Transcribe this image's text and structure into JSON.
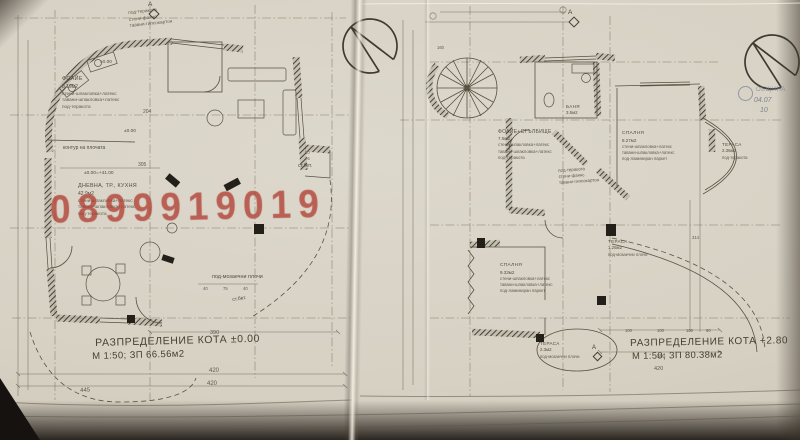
{
  "watermark": {
    "text": "0899919019",
    "color": "#bf483c"
  },
  "colors": {
    "paper": "#d7d1c4",
    "ink": "#544d3e",
    "walls": "#2e2a22",
    "stamp": "#74839b"
  },
  "icons": {
    "north_arrow": "circle-with-wedge",
    "section_marker": "letter-with-diamond",
    "stamp_emblem": "circle"
  },
  "left": {
    "title1": "РАЗПРЕДЕЛЕНИЕ КОТА ±0.00",
    "title2": "М 1:50;  ЗП 66.56м2",
    "marker": "А",
    "wc_fin": {
      "f1": "под-теракота",
      "f2": "стени-фаянс",
      "f3": "тавани-гипсокартон"
    },
    "foyer": {
      "name": "ФОАЙЕ",
      "area": "8.19м2",
      "f1": "стени-шпакловка+латекс",
      "f2": "тавани-шпакловка+латекс",
      "f3": "под-теракота"
    },
    "living": {
      "name": "ДНЕВНА, ТР., КУХНЯ",
      "area": "42.9м2",
      "f1": "стени-шпакловка+латекс",
      "f2": "тавани-шпакловка+латекс",
      "f3": "под-теракота"
    },
    "notes": {
      "slab": "контур на плочата",
      "mosaic": "под-мозаечни плочи",
      "conc1": "ст.бет.",
      "conc2": "ст.бет.",
      "level_a": "±0.00",
      "level_b": "±0.00",
      "level_eq": "±0.00=+41.00"
    },
    "dims": {
      "d390": "390",
      "d420a": "420",
      "d420b": "420",
      "d445": "445",
      "d305": "305",
      "d204": "204",
      "d40a": "40",
      "d75": "75",
      "d40b": "40",
      "d80": "80",
      "d76": "76"
    }
  },
  "right": {
    "title1": "РАЗПРЕДЕЛЕНИЕ КОТА +2.80",
    "title2": "М 1:50;  ЗП 80.38м2",
    "marker_top": "А",
    "marker_bottom": "А",
    "hall": {
      "name": "ФОАЙЕ+СТЪЛБИЩЕ",
      "area": "7.5м2",
      "f1": "стени-шпакловка+латекс",
      "f2": "тавани-шпакловка+латекс",
      "f3": "под-теракота"
    },
    "bath": {
      "name": "БАНЯ",
      "area": "3.5м2"
    },
    "wc_fin": {
      "f1": "под-теракота",
      "f2": "стени-фаянс",
      "f3": "тавани-гипсокартон"
    },
    "bed1": {
      "name": "СПАЛНЯ",
      "area": "8.27м2",
      "f1": "стени-шпакловка+латекс",
      "f2": "тавани-шпакловка+латекс",
      "f3": "под-ламиниран паркет"
    },
    "terrace1": {
      "name": "ТЕРАСА",
      "area": "2.36м2",
      "f1": "под-теракота"
    },
    "terrace2": {
      "name": "ТЕРАСА",
      "area": "1.25м2",
      "f1": "под-мозаечни плочи"
    },
    "bed2": {
      "name": "СПАЛНЯ",
      "area": "9.33м2",
      "f1": "стени-шпакловка+латекс",
      "f2": "тавани-шпакловка+латекс",
      "f3": "под-ламиниран паркет"
    },
    "terrace3": {
      "name": "ТЕРАСА",
      "area": "2.3м2",
      "f1": "под-мозаечни плочи"
    },
    "stamp": {
      "line1": "ОБЩИНА",
      "note": "04.07",
      "num": "10"
    },
    "dims": {
      "d390": "390",
      "d420": "420",
      "d314": "314",
      "d160": "160",
      "d100a": "100",
      "d100b": "100",
      "d100c": "100",
      "d90": "90"
    }
  }
}
